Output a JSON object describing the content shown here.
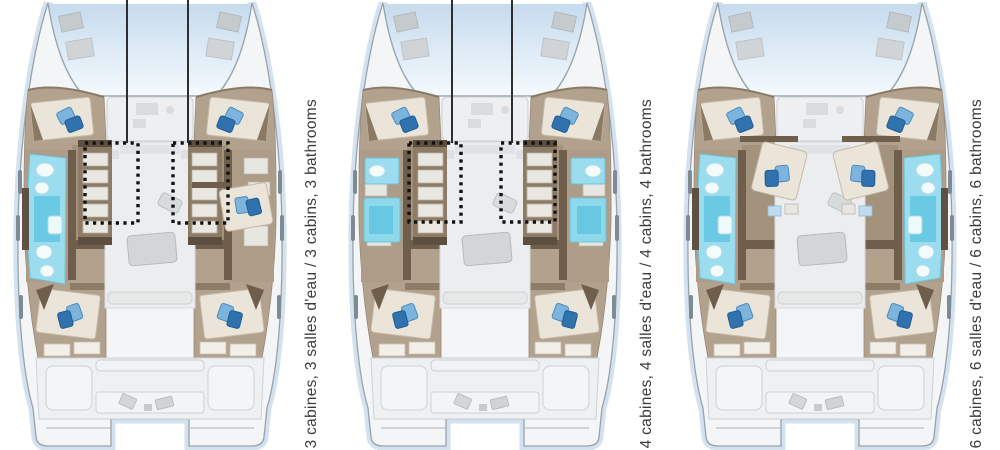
{
  "colors": {
    "background": "#ffffff",
    "hull_glow": "#b7cee6",
    "deck": "#f3f5f6",
    "hull_outline": "#96a3ad",
    "cabin_floor": "#b2a18d",
    "wood_dark": "#6e5e4b",
    "bathroom_cyan": "#9bdcee",
    "bathroom_cyan_deep": "#62c6e1",
    "pillow_light": "#7db4dd",
    "pillow_dark": "#2f72ae",
    "annotation": "#111111",
    "leader": "#2e2e2e",
    "label_text": "#3b3b3b"
  },
  "plans": [
    {
      "id": "layout-3-cabins",
      "label": "3 cabines, 3 salles d'eau / 3 cabins, 3 bathrooms",
      "label_fr": "3 cabines, 3 salles d'eau",
      "label_en": "3 cabins, 3 bathrooms",
      "cabins": 3,
      "bathrooms": 3,
      "features": [
        "galley",
        "bath_port_long",
        "bed_stbd_mid"
      ],
      "highlight_boxes": [
        {
          "x": 75,
          "y": 143,
          "w": 53,
          "h": 80
        },
        {
          "x": 163,
          "y": 143,
          "w": 55,
          "h": 80
        }
      ],
      "leader_lines_x": [
        117,
        178
      ]
    },
    {
      "id": "layout-4-cabins",
      "label": "4 cabines, 4 salles d'eau / 4 cabins, 4 bathrooms",
      "label_fr": "4 cabines, 4 salles d'eau",
      "label_en": "4 cabins, 4 bathrooms",
      "cabins": 4,
      "bathrooms": 4,
      "features": [
        "galley",
        "bath_small_both"
      ],
      "highlight_boxes": [
        {
          "x": 64,
          "y": 143,
          "w": 52,
          "h": 79
        },
        {
          "x": 156,
          "y": 143,
          "w": 54,
          "h": 79
        }
      ],
      "leader_lines_x": [
        107,
        167
      ]
    },
    {
      "id": "layout-6-cabins",
      "label": "6 cabines, 6 salles d'eau / 6 cabins, 6 bathrooms",
      "label_fr": "6 cabines, 6 salles d'eau",
      "label_en": "6 cabins, 6 bathrooms",
      "cabins": 6,
      "bathrooms": 6,
      "features": [
        "bath_long_both",
        "mid_beds_both"
      ],
      "highlight_boxes": [],
      "leader_lines_x": []
    }
  ]
}
